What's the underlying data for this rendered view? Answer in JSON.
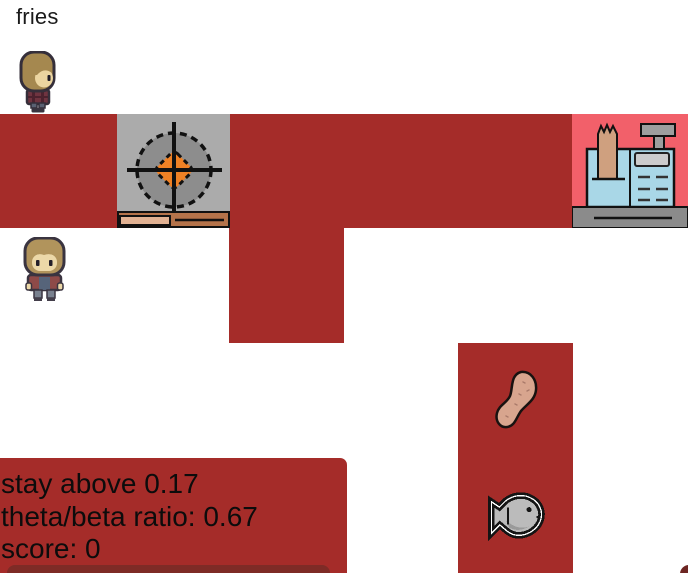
{
  "order": {
    "label": "fries"
  },
  "status_panel": {
    "lines": [
      "stay above 0.17",
      "theta/beta ratio: 0.67",
      "score: 0"
    ]
  },
  "icons": {
    "player_top": "chef-character-icon",
    "player_mid": "chef-character-icon",
    "stove": "stove-burner-icon",
    "register": "cash-register-icon",
    "potato": "potato-icon",
    "fish": "fish-icon"
  },
  "colors": {
    "floor_red": "#a52c29",
    "panel_dark_red": "#7e2b26",
    "register_tile_pink": "#f2606a",
    "stove_gray": "#ababab",
    "burner_orange": "#ef8125",
    "register_blue": "#a9d7e7",
    "text_black": "#0c0c0c"
  }
}
